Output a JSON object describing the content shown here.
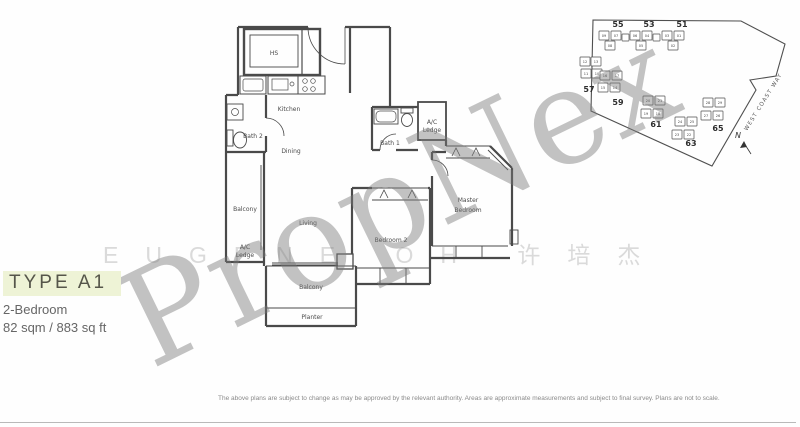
{
  "header": {
    "type_label": "TYPE A1",
    "bedrooms": "2-Bedroom",
    "area": "82 sqm / 883 sq ft",
    "highlight_color": "#eef3d6"
  },
  "floor_plan": {
    "rooms": {
      "hs": "HS",
      "kitchen": "Kitchen",
      "bath2": "Bath 2",
      "dining": "Dining",
      "bath1": "Bath 1",
      "ac_ledge_right_1": "A/C",
      "ac_ledge_right_2": "Ledge",
      "balcony_left": "Balcony",
      "living": "Living",
      "ac_ledge_left_1": "A/C",
      "ac_ledge_left_2": "Ledge",
      "master_1": "Master",
      "master_2": "Bedroom",
      "bedroom2": "Bedroom 2",
      "balcony_bottom": "Balcony",
      "planter": "Planter"
    }
  },
  "site_map": {
    "street_name": "WEST COAST WAY",
    "north_label": "N",
    "clusters": [
      {
        "label": "55",
        "units": [
          "09",
          "07",
          "08"
        ]
      },
      {
        "label": "53",
        "units": [
          "06",
          "04",
          "05"
        ]
      },
      {
        "label": "51",
        "units": [
          "03",
          "01",
          "02"
        ]
      },
      {
        "label": "57",
        "units": [
          "12",
          "13",
          "11",
          "10"
        ]
      },
      {
        "label": "59",
        "units": [
          "16",
          "17",
          "15",
          "14"
        ]
      },
      {
        "label": "61",
        "units": [
          "20",
          "21",
          "19",
          "18"
        ]
      },
      {
        "label": "65",
        "units": [
          "28",
          "29",
          "27",
          "26"
        ]
      },
      {
        "label": "63",
        "units": [
          "24",
          "25",
          "23",
          "22"
        ]
      }
    ]
  },
  "watermarks": {
    "brand": "PropNex",
    "agent": "EUGENE OH 许培杰"
  },
  "footer": {
    "disclaimer": "The above plans are subject to change as may be approved by the relevant authority. Areas are approximate measurements and subject to final survey. Plans are not to scale."
  },
  "colors": {
    "wall": "#4a4a4a",
    "highlight": "#eef3d6",
    "watermark_brand": "#7a7a7a",
    "watermark_agent": "#cdcdcd"
  }
}
